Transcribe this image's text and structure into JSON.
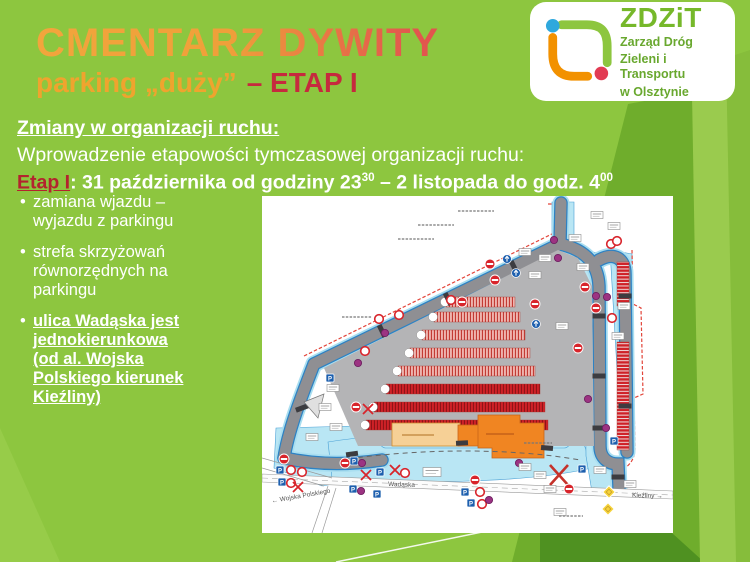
{
  "slide": {
    "title": "CMENTARZ DYWITY",
    "subtitle_orange": "parking „duży”",
    "subtitle_red": "– ETAP I"
  },
  "logo": {
    "acronym": "ZDZiT",
    "line1": "Zarząd Dróg",
    "line2": "Zieleni i Transportu",
    "line3": "w Olsztynie"
  },
  "content": {
    "heading": "Zmiany w organizacji ruchu:",
    "intro": "Wprowadzenie etapowości tymczasowej organizacji ruchu:",
    "etap_label": "Etap I",
    "etap_sep": ": ",
    "etap_text_1": "31 października od godziny 23",
    "etap_sup_1": "30",
    "etap_text_2": " – 2 listopada do godz. 4",
    "etap_sup_2": "00",
    "bullet_glyph": "•",
    "bullets": [
      {
        "text": "zamiana wjazdu – wyjazdu z parkingu",
        "emphasis": false
      },
      {
        "text": "strefa skrzyżowań równorzędnych na parkingu",
        "emphasis": false
      },
      {
        "text": "ulica Wadąska jest jednokierunkowa (od al. Wojska Polskiego kierunek Kieźliny)",
        "emphasis": true
      }
    ]
  },
  "map": {
    "street_labels": [
      {
        "text": "Wojska Polskiego",
        "x": 10,
        "y": 307,
        "rotate": -10,
        "arrow": "left"
      },
      {
        "text": "Wadąska",
        "x": 126,
        "y": 290,
        "rotate": 2,
        "arrow": "none"
      },
      {
        "text": "Kieźliny",
        "x": 370,
        "y": 301,
        "rotate": 2,
        "arrow": "right"
      }
    ],
    "arrow_glyphs": {
      "left": "← ",
      "right": " →"
    },
    "sign_glyphs": {
      "parking": "P"
    },
    "parking_rows": [
      {
        "x": 184,
        "w": 69,
        "y": 101,
        "solid": false
      },
      {
        "x": 172,
        "w": 86,
        "y": 116,
        "solid": false
      },
      {
        "x": 160,
        "w": 103,
        "y": 134,
        "solid": false
      },
      {
        "x": 148,
        "w": 120,
        "y": 152,
        "solid": false
      },
      {
        "x": 136,
        "w": 137,
        "y": 170,
        "solid": false
      },
      {
        "x": 124,
        "w": 154,
        "y": 188,
        "solid": true
      },
      {
        "x": 112,
        "w": 171,
        "y": 206,
        "solid": true
      },
      {
        "x": 104,
        "w": 182,
        "y": 224,
        "solid": true
      }
    ],
    "side_strips": [
      {
        "x": 355,
        "y": 66,
        "w": 12,
        "h": 44
      },
      {
        "x": 355,
        "y": 146,
        "w": 12,
        "h": 108
      }
    ],
    "signs": [
      {
        "t": "purple",
        "x": 292,
        "y": 44
      },
      {
        "t": "label",
        "x": 313,
        "y": 42
      },
      {
        "t": "ring",
        "x": 349,
        "y": 48
      },
      {
        "t": "label",
        "x": 263,
        "y": 56
      },
      {
        "t": "blue-round",
        "x": 245,
        "y": 63
      },
      {
        "t": "no-entry",
        "x": 228,
        "y": 68
      },
      {
        "t": "blue-round",
        "x": 254,
        "y": 77
      },
      {
        "t": "no-entry",
        "x": 233,
        "y": 84
      },
      {
        "t": "label",
        "x": 273,
        "y": 79
      },
      {
        "t": "label",
        "x": 283,
        "y": 62
      },
      {
        "t": "purple",
        "x": 296,
        "y": 62
      },
      {
        "t": "label",
        "x": 321,
        "y": 71
      },
      {
        "t": "label",
        "x": 335,
        "y": 19
      },
      {
        "t": "label",
        "x": 352,
        "y": 30
      },
      {
        "t": "ring",
        "x": 355,
        "y": 45
      },
      {
        "t": "no-entry",
        "x": 323,
        "y": 91
      },
      {
        "t": "purple",
        "x": 334,
        "y": 100
      },
      {
        "t": "purple",
        "x": 345,
        "y": 101
      },
      {
        "t": "no-entry",
        "x": 334,
        "y": 112
      },
      {
        "t": "label",
        "x": 362,
        "y": 110
      },
      {
        "t": "ring",
        "x": 350,
        "y": 122
      },
      {
        "t": "label",
        "x": 356,
        "y": 140
      },
      {
        "t": "no-entry",
        "x": 316,
        "y": 152
      },
      {
        "t": "purple",
        "x": 326,
        "y": 203
      },
      {
        "t": "purple",
        "x": 344,
        "y": 232
      },
      {
        "t": "blue-sq",
        "x": 352,
        "y": 245
      },
      {
        "t": "no-entry",
        "x": 273,
        "y": 108
      },
      {
        "t": "blue-round",
        "x": 274,
        "y": 128
      },
      {
        "t": "label",
        "x": 300,
        "y": 130
      },
      {
        "t": "ring",
        "x": 189,
        "y": 104
      },
      {
        "t": "no-entry",
        "x": 200,
        "y": 106
      },
      {
        "t": "ring",
        "x": 137,
        "y": 119
      },
      {
        "t": "ring",
        "x": 117,
        "y": 123
      },
      {
        "t": "purple",
        "x": 123,
        "y": 137
      },
      {
        "t": "ring",
        "x": 103,
        "y": 155
      },
      {
        "t": "purple",
        "x": 96,
        "y": 167
      },
      {
        "t": "blue-sq",
        "x": 68,
        "y": 182
      },
      {
        "t": "label",
        "x": 71,
        "y": 192
      },
      {
        "t": "label",
        "x": 63,
        "y": 211
      },
      {
        "t": "no-entry",
        "x": 94,
        "y": 211
      },
      {
        "t": "red-x",
        "x": 106,
        "y": 213
      },
      {
        "t": "label",
        "x": 74,
        "y": 231
      },
      {
        "t": "label",
        "x": 50,
        "y": 241
      },
      {
        "t": "no-entry",
        "x": 22,
        "y": 263
      },
      {
        "t": "blue-sq",
        "x": 18,
        "y": 274
      },
      {
        "t": "ring",
        "x": 29,
        "y": 274
      },
      {
        "t": "ring",
        "x": 40,
        "y": 276
      },
      {
        "t": "blue-sq",
        "x": 20,
        "y": 286
      },
      {
        "t": "ring",
        "x": 29,
        "y": 287
      },
      {
        "t": "red-x",
        "x": 36,
        "y": 291
      },
      {
        "t": "no-entry",
        "x": 83,
        "y": 267
      },
      {
        "t": "blue-sq",
        "x": 92,
        "y": 265
      },
      {
        "t": "purple",
        "x": 100,
        "y": 267
      },
      {
        "t": "red-x",
        "x": 104,
        "y": 279
      },
      {
        "t": "blue-sq",
        "x": 118,
        "y": 276
      },
      {
        "t": "red-x",
        "x": 133,
        "y": 274
      },
      {
        "t": "ring",
        "x": 143,
        "y": 277
      },
      {
        "t": "label-lg",
        "x": 170,
        "y": 276
      },
      {
        "t": "blue-sq",
        "x": 91,
        "y": 293
      },
      {
        "t": "purple",
        "x": 99,
        "y": 295
      },
      {
        "t": "blue-sq",
        "x": 115,
        "y": 298
      },
      {
        "t": "no-entry",
        "x": 213,
        "y": 284
      },
      {
        "t": "blue-sq",
        "x": 203,
        "y": 296
      },
      {
        "t": "ring",
        "x": 218,
        "y": 296
      },
      {
        "t": "blue-sq",
        "x": 209,
        "y": 307
      },
      {
        "t": "ring",
        "x": 220,
        "y": 308
      },
      {
        "t": "purple",
        "x": 227,
        "y": 304
      },
      {
        "t": "purple",
        "x": 257,
        "y": 267
      },
      {
        "t": "label",
        "x": 263,
        "y": 271
      },
      {
        "t": "label",
        "x": 278,
        "y": 279
      },
      {
        "t": "red-x-lg",
        "x": 297,
        "y": 279
      },
      {
        "t": "no-entry",
        "x": 307,
        "y": 293
      },
      {
        "t": "label",
        "x": 288,
        "y": 293
      },
      {
        "t": "blue-sq",
        "x": 320,
        "y": 273
      },
      {
        "t": "label",
        "x": 338,
        "y": 274
      },
      {
        "t": "yellow-diamond",
        "x": 347,
        "y": 296
      },
      {
        "t": "yellow-diamond",
        "x": 346,
        "y": 313
      },
      {
        "t": "label",
        "x": 298,
        "y": 316
      },
      {
        "t": "label",
        "x": 368,
        "y": 288
      }
    ]
  },
  "colors": {
    "background_green": "#8DC63F",
    "facet_dark_green": "#4F9121",
    "facet_medium_green": "#6FAD2C",
    "facet_light_green": "#9ACB4E",
    "title_gradient_start": "#F2A53C",
    "title_gradient_end": "#DF4F49",
    "subtitle_orange": "#EFA42E",
    "etap_red": "#C62A3E",
    "body_text": "#FFFFFF",
    "logo_green": "#76B82A",
    "logo_orange": "#F29100",
    "logo_blue": "#2FA8DD",
    "logo_red": "#E23B53",
    "map_parking_red": "#CF2127",
    "map_building_orange": "#F08522",
    "map_road_gray": "#8F8F93",
    "map_sidewalk_cyan": "#B9E6F4"
  }
}
